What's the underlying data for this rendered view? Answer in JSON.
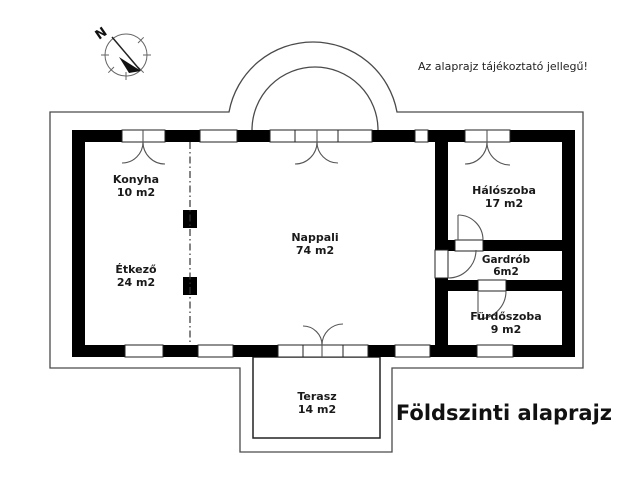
{
  "meta": {
    "disclaimer": "Az alaprajz tájékoztató jellegű!",
    "title": "Földszinti alaprajz"
  },
  "compass": {
    "north_label": "N"
  },
  "rooms": [
    {
      "name": "Konyha",
      "area": "10 m2"
    },
    {
      "name": "Étkező",
      "area": "24 m2"
    },
    {
      "name": "Nappali",
      "area": "74 m2"
    },
    {
      "name": "Hálószoba",
      "area": "17 m2"
    },
    {
      "name": "Gardrób",
      "area": "6m2"
    },
    {
      "name": "Fürdőszoba",
      "area": "9 m2"
    },
    {
      "name": "Terasz",
      "area": "14 m2"
    }
  ],
  "colors": {
    "wall": "#000000",
    "thin_line": "#4a4a4a",
    "text": "#1a1a1a"
  }
}
